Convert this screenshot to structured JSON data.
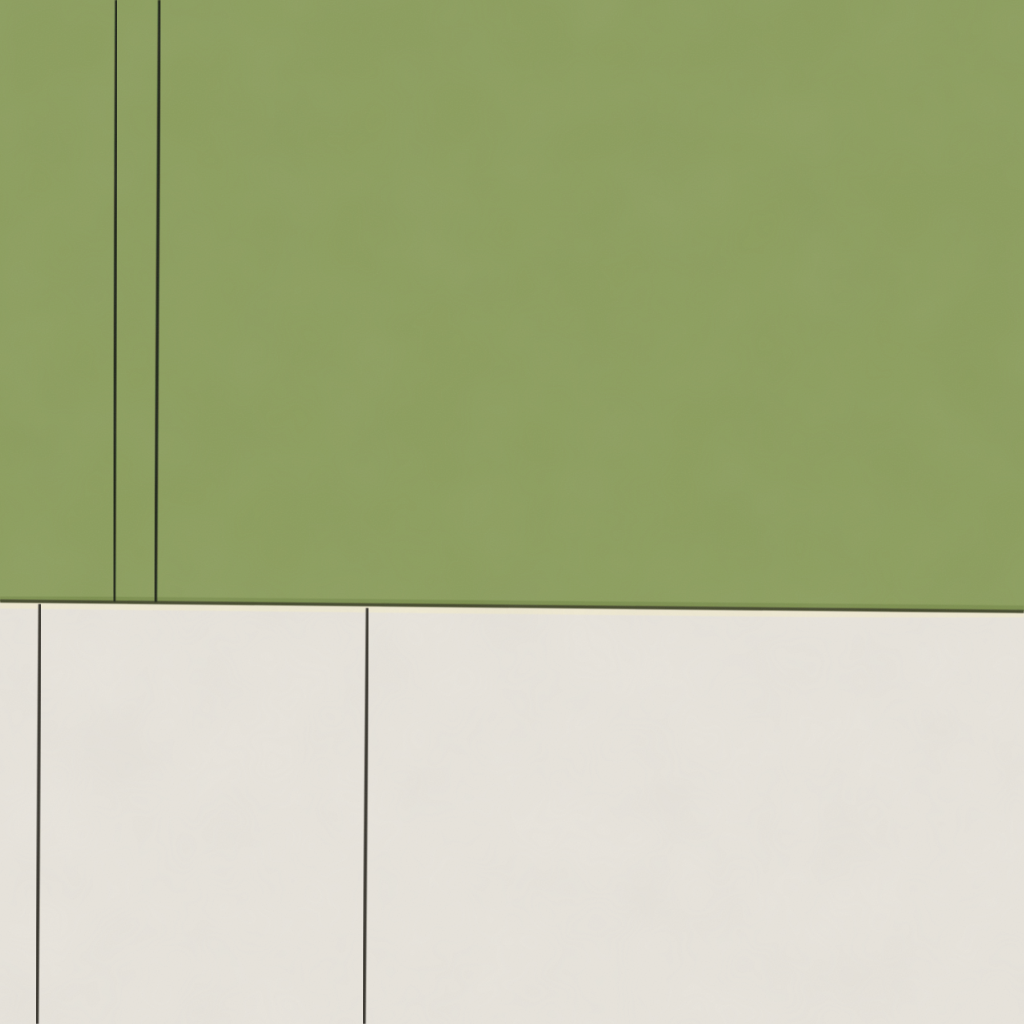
{
  "scene": {
    "description": "Close-up photograph of two adjoining sheets of paper: olive-green cardstock above, off-white paper below, separated by a dark horizontal rule with a pale worn highlight under it. Thin near-vertical dark rules cross each sheet.",
    "regions": {
      "top": "olive-green paper",
      "bottom": "off-white paper"
    }
  },
  "colors": {
    "green_paper": "#8c9e5d",
    "green_paper_edge": "#7d904f",
    "cream_paper": "#e8e4dc",
    "boundary_line": "#43462a",
    "boundary_highlight": "#efe9d2",
    "green_rule_line": "#1f2315",
    "cream_rule_line": "#35322b",
    "grain_tint": "#808080"
  }
}
